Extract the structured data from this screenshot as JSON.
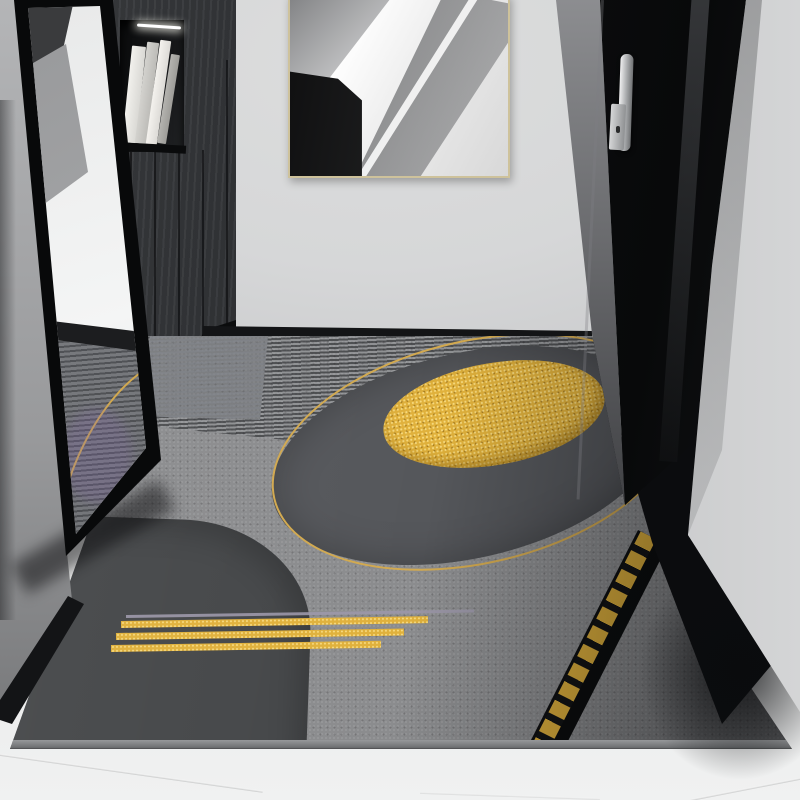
{
  "scene": {
    "description": "Modern hallway entryway photo: gray geometric rug with gold circle outline, gold foil ellipse, gold stripes and dashed gold edge band; leaning black-framed mirror reflecting the rug; dark wood cabinet with open shelf of books and LED light; abstract black-and-white framed artwork on the wall; black entry door with silver handle; light gray walls and tile floor.",
    "objects": {
      "walls": {
        "label": "light gray hallway walls"
      },
      "floor": {
        "label": "light gray tile floor with seams"
      },
      "artwork": {
        "label": "abstract black and white geometric artwork in thin gold frame"
      },
      "cabinet": {
        "label": "dark wood cabinet with open shelf, books and LED strip"
      },
      "mirror": {
        "label": "black-framed leaning floor mirror reflecting the rug"
      },
      "door": {
        "label": "black entry door with vertical silver handle and lock"
      },
      "rug": {
        "label": "gray entry rug with gold circle outline, gold foil ellipse, dark disc, rounded dark block, gold stripes and dashed gold edge band"
      }
    }
  },
  "palette": {
    "wall_light": "#cdced0",
    "wall_mid": "#b4b5b7",
    "back_wall": "#d6d7d8",
    "floor_tile": "#e7e8e8",
    "skirting": "#131416",
    "rug_base": "#8b8c8e",
    "rug_disc": "#55575b",
    "rug_shape": "#454749",
    "rug_binding": "#97999b",
    "gold_line": "#d2a94f",
    "gold_foil": "#e0b13c",
    "gold_hi": "#f6d97e",
    "gold_dark": "#a67c20",
    "silver_line": "#9b97a8",
    "door_black": "#0d0e10",
    "cabinet_wood": "#2e3033",
    "cabinet_plinth": "#0b0c0d",
    "book_light": "#d9d8d4",
    "book_mid": "#bcbbb7",
    "led": "#ffffff",
    "mirror_frame": "#08090a",
    "glass_light": "#f4f5f5",
    "art_frame": "#cec29b",
    "metal": "#a7a9ab"
  }
}
